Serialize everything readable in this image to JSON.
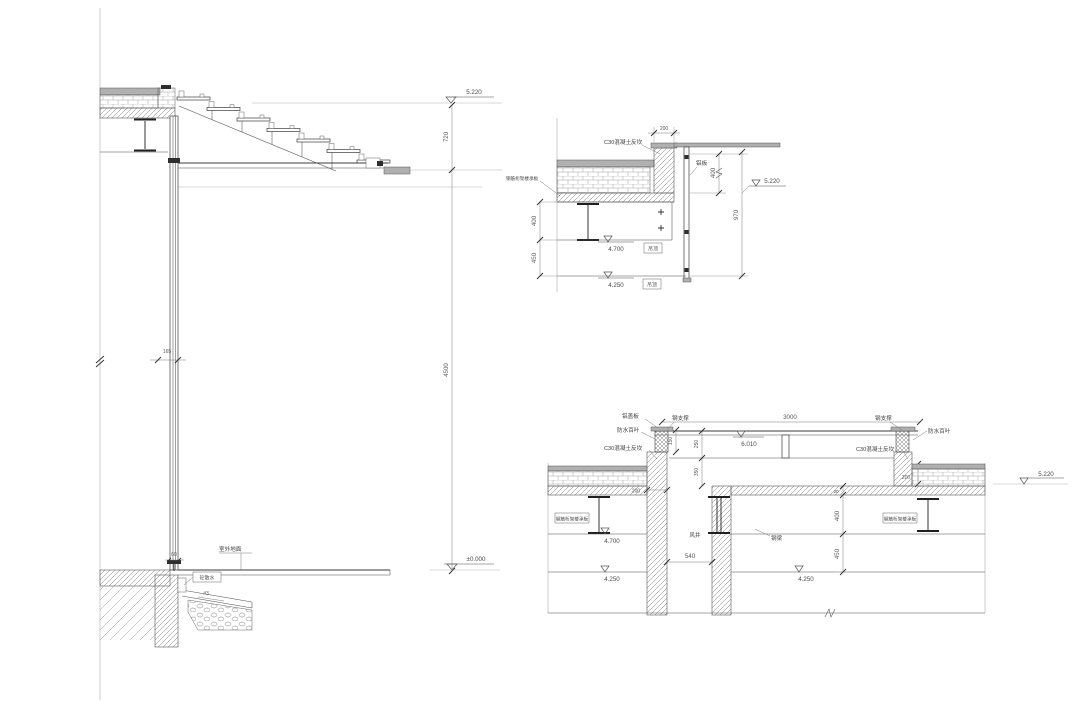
{
  "colors": {
    "line": "#3b3b3b",
    "panel_gray": "#b0b0b0",
    "dim_text": "#5a5a5a"
  },
  "left_section": {
    "elev_top": "5.220",
    "dim_step_zone": "720",
    "dim_storey": "4500",
    "dim_mullion": "165",
    "elev_ground": "±0.000",
    "label_outdoor_ground": "室外地面",
    "dim_ground_offset": "60",
    "label_apron": "砼散水",
    "label_slope": "#3"
  },
  "detail_top_right": {
    "dim_top": "200",
    "label_c30": "C30混凝土反坎",
    "label_deck": "钢筋桁架楼承板",
    "label_alum_panel": "铝板",
    "dim_right_400": "400",
    "elev_5220": "5.220",
    "dim_right_970": "970",
    "dim_left_400": "400",
    "dim_left_450": "450",
    "elev_4700": "4.700",
    "tag_4700": "吊顶",
    "elev_4250": "4.250",
    "tag_4250": "吊顶"
  },
  "detail_bottom_right": {
    "label_alum_cover": "铝盖板",
    "label_steel_brace_left": "钢支撑",
    "label_louver_left": "防水百叶",
    "label_c30_left": "C30混凝土反坎",
    "dim_canopy_width": "3000",
    "elev_canopy": "6.010",
    "dim_150": "150",
    "dim_250": "250",
    "dim_350": "350",
    "label_steel_brace_right": "钢支撑",
    "label_louver_right": "防水百叶",
    "label_c30_right": "C30混凝土反坎",
    "dim_200_wall": "200",
    "dim_200_right": "200",
    "dim_20": "20",
    "elev_5220": "5.220",
    "label_deck_left": "钢筋桁架楼承板",
    "label_deck_right": "钢筋桁架楼承板",
    "elev_4700": "4.700",
    "elev_4250_left": "4.250",
    "elev_4250_right": "4.250",
    "label_shaft": "风井",
    "dim_shaft": "540",
    "dim_400": "400",
    "dim_450": "450",
    "label_steel_beam": "钢梁"
  }
}
